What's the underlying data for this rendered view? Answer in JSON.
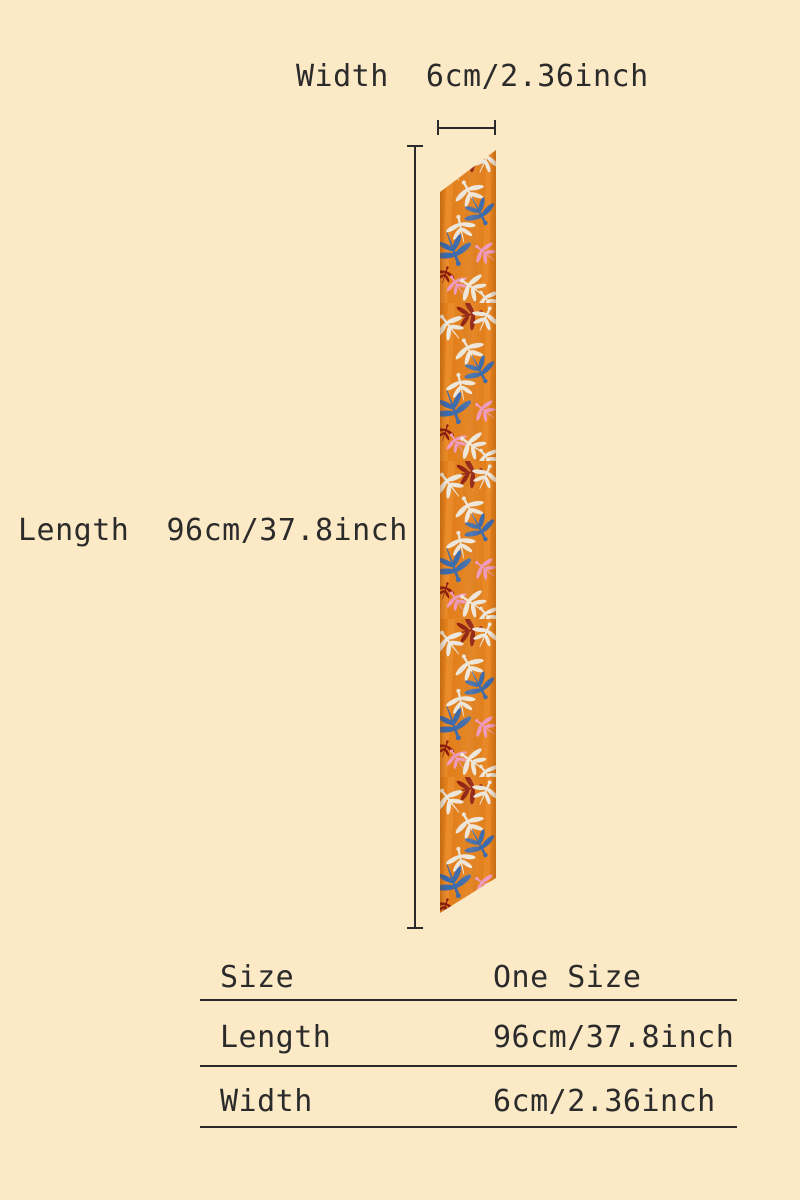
{
  "page": {
    "background_color": "#FCEAC6",
    "text_color": "#2B2B2B"
  },
  "diagram": {
    "width_label": "Width  6cm/2.36inch",
    "length_label": "Length  96cm/37.8inch",
    "scarf_description": "orange skinny scarf with dragonfly print"
  },
  "size_table": {
    "rows": [
      {
        "label": "Size",
        "value": "One Size"
      },
      {
        "label": "Length",
        "value": "96cm/37.8inch"
      },
      {
        "label": "Width",
        "value": "6cm/2.36inch"
      }
    ]
  },
  "colors": {
    "scarf_orange": "#E5811C",
    "scarf_orange_light": "#F7A044",
    "scarf_orange_dark": "#CC6A10",
    "dragonfly_white": "#EFEBE2",
    "dragonfly_blue": "#3A6BB0",
    "dragonfly_pink": "#F09CC4",
    "dragonfly_red": "#8C1A0E",
    "measure_line": "#2B2B2B"
  }
}
